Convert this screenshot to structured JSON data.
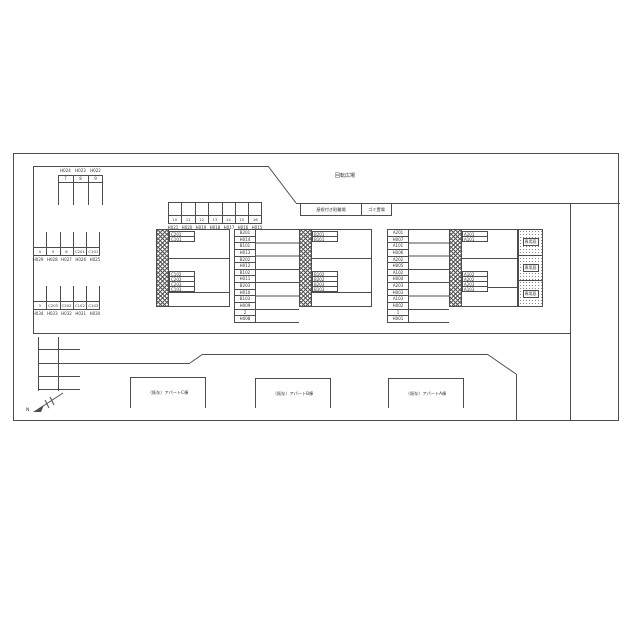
{
  "site": {
    "rotation_plaza": "回転広場",
    "bike_shed": "屋根付き駐輪場",
    "garbage": "ゴミ置場",
    "north_label": "N",
    "buildings": {
      "c": "（既存）アパートC棟",
      "b": "（既存）アパートB棟",
      "a": "（既存）アパートA棟"
    }
  },
  "stalls": {
    "top_left": {
      "labels_above": [
        "H024",
        "H023",
        "H022"
      ],
      "numbers": [
        "7",
        "8",
        "9"
      ]
    },
    "mid_left": {
      "cells": [
        "4",
        "5",
        "6",
        "C201",
        "C101"
      ],
      "labels_below": [
        "H029",
        "H028",
        "H027",
        "H026",
        "H025"
      ]
    },
    "low_left": {
      "cells": [
        "3",
        "C203",
        "C202",
        "C102",
        "C103"
      ],
      "labels_below": [
        "H034",
        "H033",
        "H032",
        "H031",
        "H030"
      ]
    },
    "center_top": {
      "numbers": [
        "10",
        "11",
        "12",
        "13",
        "14",
        "15",
        "16"
      ],
      "labels_below": [
        "H021",
        "H020",
        "H019",
        "H018",
        "H017",
        "H016",
        "H015"
      ]
    }
  },
  "blocks": {
    "c": {
      "top": [
        "C201",
        "C101"
      ],
      "lower": [
        "C102",
        "C202",
        "C203",
        "C103"
      ]
    },
    "b": {
      "top": [
        "B201",
        "B101"
      ],
      "lower": [
        "B102",
        "B202",
        "B203",
        "B103"
      ]
    },
    "a": {
      "top": [
        "A201",
        "A101"
      ],
      "lower": [
        "A102",
        "A202",
        "A203",
        "A103"
      ]
    }
  },
  "columns": {
    "b": [
      "B201",
      "H014",
      "B101",
      "H013",
      "B202",
      "H012",
      "B102",
      "H011",
      "B203",
      "H010",
      "B103",
      "H009",
      "2",
      "H008"
    ],
    "a": [
      "A201",
      "H007",
      "A101",
      "H006",
      "A202",
      "H005",
      "A102",
      "H004",
      "A203",
      "H003",
      "A103",
      "H002",
      "1",
      "H001"
    ]
  },
  "gardens": [
    "専用庭",
    "専用庭",
    "専用庭"
  ],
  "colors": {
    "line": "#4d4d4d",
    "text": "#333333",
    "background": "#ffffff"
  }
}
